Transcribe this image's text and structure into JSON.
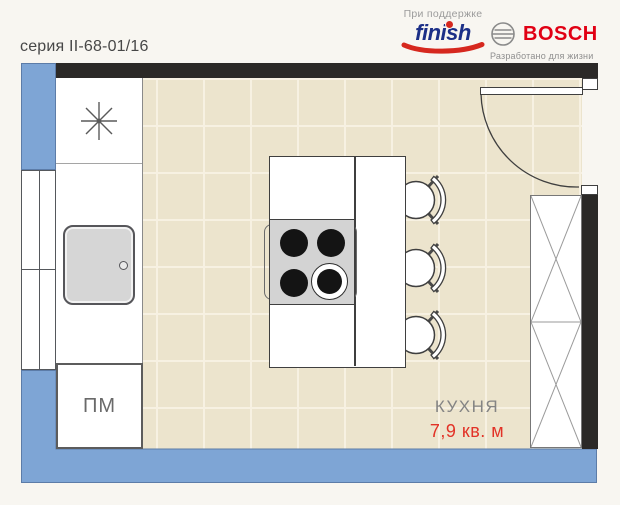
{
  "page": {
    "series_label": "серия II-68-01/16"
  },
  "sponsors": {
    "supported_by": "При поддержке",
    "finish": {
      "wordmark": "finish",
      "text_color": "#1c2f87",
      "accent_color": "#d6281e"
    },
    "bosch": {
      "wordmark": "BOSCH",
      "tagline": "Разработано для жизни",
      "text_color": "#e10014",
      "emblem_icon": "bosch-armature-icon"
    }
  },
  "floorplan": {
    "room_label": "КУХНЯ",
    "room_area": "7,9 кв. м",
    "dishwasher_label": "ПМ",
    "icons": {
      "fridge": "snowflake-asterisk-icon",
      "sink": "sink-basin-shape",
      "cooktop": "four-burner-cooktop-shape",
      "stools": "round-stool-with-backrest-x3",
      "door": "swing-door-arc",
      "wardrobe": "crossed-panel-cabinet"
    },
    "colors": {
      "wall": "#2b2927",
      "balcony_blue": "#7ea5d5",
      "floor": "#ece4cd",
      "floor_grid": "#f7f1e2",
      "appliance_gray": "#d3d3d3",
      "area_red": "#e23227"
    }
  }
}
